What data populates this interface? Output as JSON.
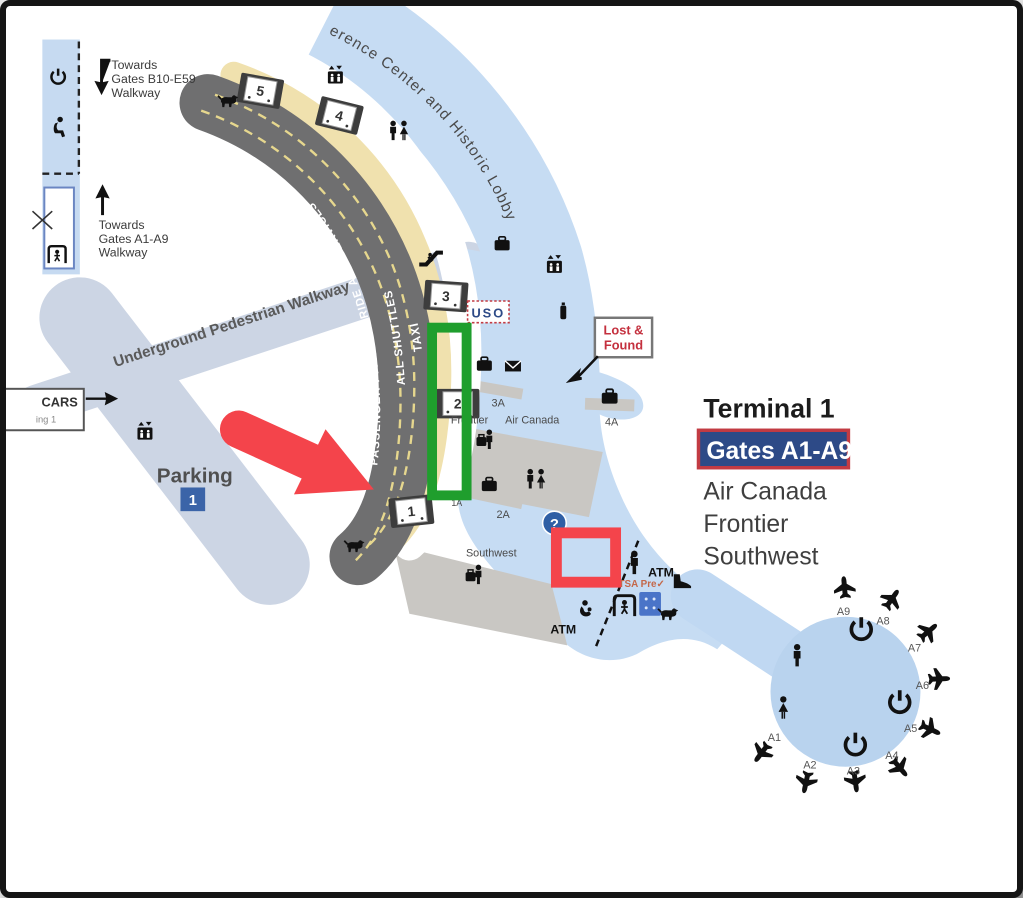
{
  "map": {
    "curved_labels": {
      "lobby": "erence Center and Historic Lobby",
      "underground": "Underground Pedestrian Walkway",
      "lane_passenger": "PASSENGER PICKUP & RIDE APP SERVICES",
      "lane_shuttles": "ALL SHUTTLES",
      "lane_taxi": "TAXI"
    },
    "directions": {
      "towards_b": {
        "l1": "Towards",
        "l2": "Gates B10-E59",
        "l3": "Walkway"
      },
      "towards_a": {
        "l1": "Towards",
        "l2": "Gates A1-A9",
        "l3": "Walkway"
      },
      "cars_box": {
        "l1": "CARS",
        "l2": "ing 1"
      }
    },
    "parking": {
      "label": "Parking",
      "number": "1"
    },
    "doors": {
      "d1": "1",
      "d2": "2",
      "d3": "3",
      "d4": "4",
      "d5": "5"
    },
    "baggage": {
      "b1a": "1A",
      "b2a": "2A",
      "b3a": "3A",
      "b4a": "4A"
    },
    "counters": {
      "frontier": "Frontier",
      "air_canada": "Air Canada",
      "southwest": "Southwest"
    },
    "signs": {
      "uso": "USO",
      "lost_found": {
        "l1": "Lost &",
        "l2": "Found"
      },
      "tsa_pre": "TSA Pre✓",
      "atm_upper": "ATM",
      "atm_lower": "ATM",
      "info": "?"
    },
    "legend": {
      "title": "Terminal 1",
      "gates": "Gates A1-A9",
      "airline1": "Air Canada",
      "airline2": "Frontier",
      "airline3": "Southwest"
    },
    "gates": {
      "a1": "A1",
      "a2": "A2",
      "a3": "A3",
      "a4": "A4",
      "a5": "A5",
      "a6": "A6",
      "a7": "A7",
      "a8": "A8",
      "a9": "A9"
    }
  },
  "colors": {
    "floor_blue": "#c6dcf3",
    "walkway_gray_blue": "#ccd5e4",
    "road_gray": "#6f6f70",
    "curb_tan": "#f0e1ae",
    "counter_gray": "#c9c7c3",
    "annotation_green": "#1f9e2d",
    "annotation_red": "#f4444b",
    "gates_box_bg": "#2d4a87",
    "gates_box_border": "#c23b43",
    "lost_found_red": "#c4303e",
    "parking_blue": "#3b64a8",
    "info_blue": "#2f5fa5"
  }
}
